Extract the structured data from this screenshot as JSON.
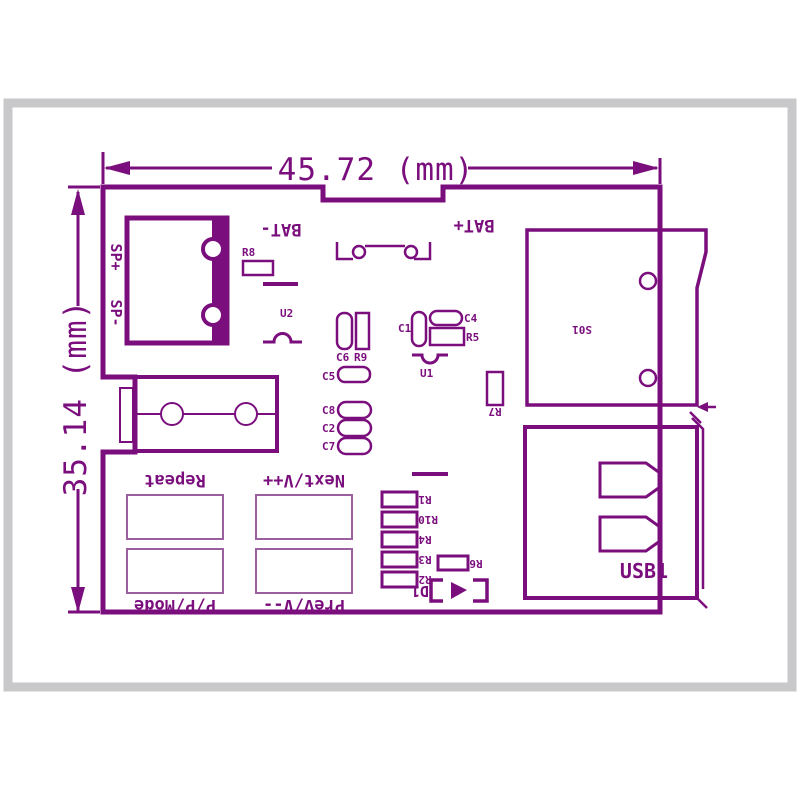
{
  "title": "PCB dimension drawing",
  "colors": {
    "line": "#7b0e7d",
    "light_line": "#9a5f9c",
    "frame_gray": "#c8c7c9",
    "background": "#ffffff"
  },
  "dimensions": {
    "width_label": "45.72 (mm)",
    "height_label": "35.14 (mm)"
  },
  "connectors": {
    "speaker_plus": "SP+",
    "speaker_minus": "SP-",
    "battery_minus": "BAT-",
    "battery_plus": "BAT+",
    "card_slot": "S01",
    "usb": "USB1"
  },
  "buttons": {
    "repeat": "Repeat",
    "next": "Next/V++",
    "prev": "Prev/V--",
    "mode": "P/P/Mode"
  },
  "components": {
    "r8": "R8",
    "u2": "U2",
    "c6": "C6",
    "r9": "R9",
    "c5": "C5",
    "c8": "C8",
    "c2": "C2",
    "c7": "C7",
    "c1": "C1",
    "c4": "C4",
    "r5": "R5",
    "u1": "U1",
    "r7": "R7",
    "r1": "R1",
    "r10": "R10",
    "r4": "R4",
    "r3": "R3",
    "r2": "R2",
    "r6": "R6",
    "d1": "D1"
  }
}
